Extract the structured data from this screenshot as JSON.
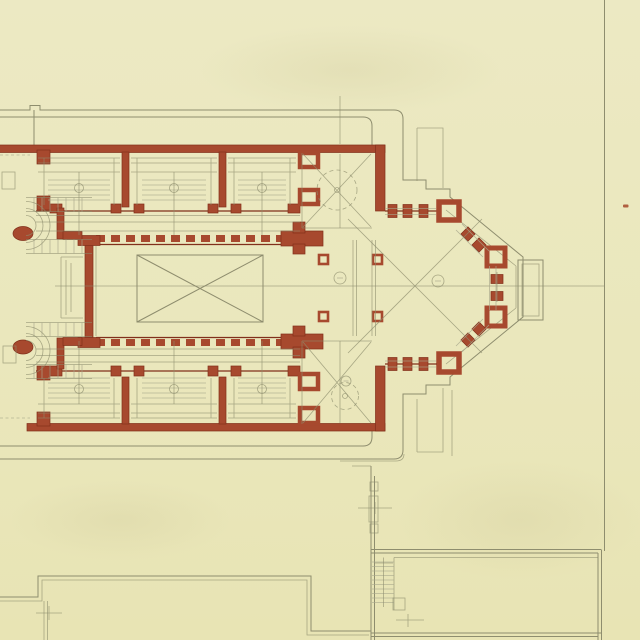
{
  "meta": {
    "title": "Scanned architectural drawing — floor plan of a church with rectangular nave, side aisle bays, crossing and polygonal apse",
    "medium": "ink and wash on cream paper",
    "visible_text": "none (tiny circled reference marks are illegible)"
  },
  "palette": {
    "paper": "#EAE7BC",
    "paper_shade": "#E2DEAE",
    "wall": "#A7492E",
    "wall_dark": "#81301B",
    "line": "#8E8D6E",
    "line_soft": "#A9A78C"
  },
  "elements": {
    "plan_label": "church-floor-plan",
    "apse_label": "polygonal-apse",
    "nave_label": "nave-with-cross-hatched-hall",
    "aisle_label": "aisle-bays-with-pews",
    "stair_label": "return-staircases",
    "annex_label": "annex-buildings",
    "page_edge_label": "sheet-edge-line"
  }
}
